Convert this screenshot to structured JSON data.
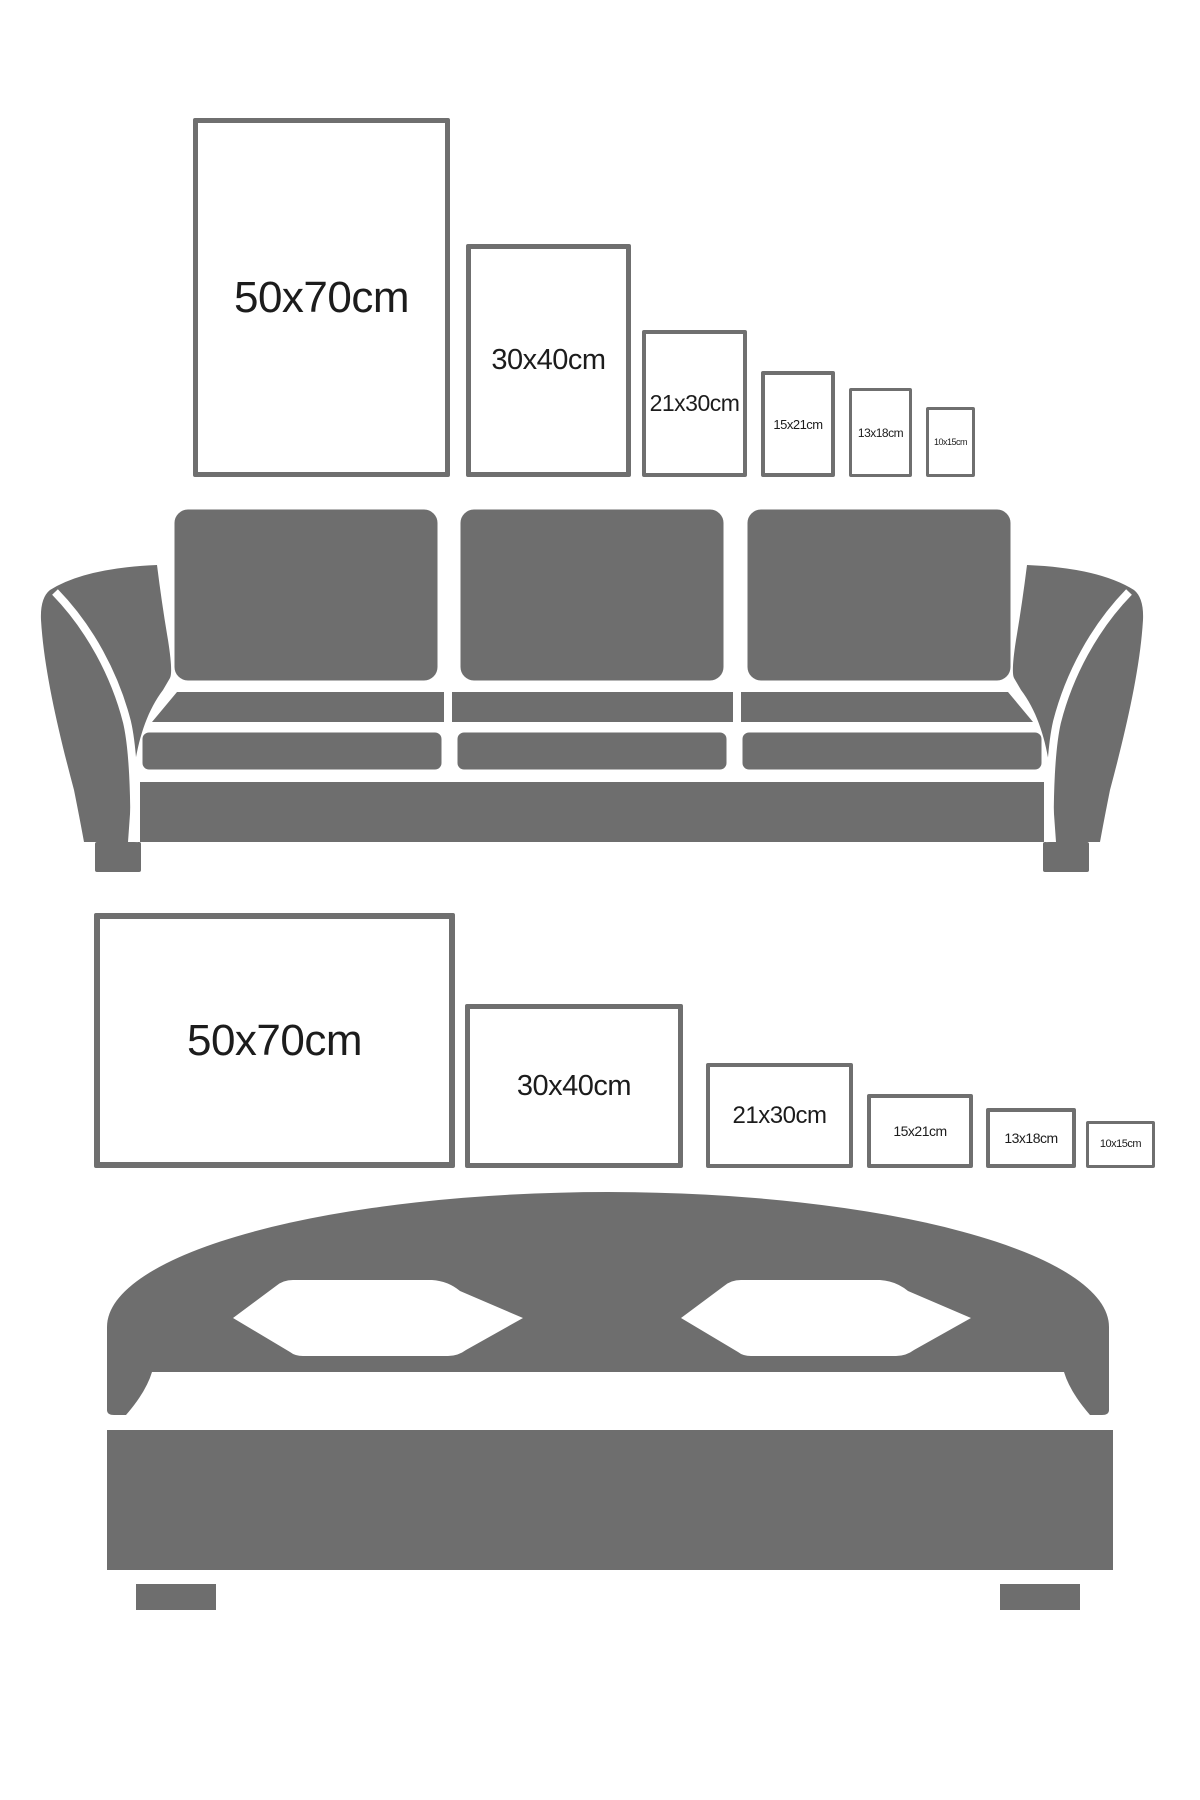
{
  "page": {
    "background_color": "#ffffff",
    "furniture_color": "#6e6e6e",
    "frame_border_color": "#6f6f6f",
    "label_color": "#1c1c1c"
  },
  "sections": [
    {
      "name": "portrait print sizes above sofa",
      "orientation": "portrait",
      "furniture": "sofa",
      "frames": [
        {
          "label": "50x70cm",
          "width_cm": 50,
          "height_cm": 70
        },
        {
          "label": "30x40cm",
          "width_cm": 30,
          "height_cm": 40
        },
        {
          "label": "21x30cm",
          "width_cm": 21,
          "height_cm": 30
        },
        {
          "label": "15x21cm",
          "width_cm": 15,
          "height_cm": 21
        },
        {
          "label": "13x18cm",
          "width_cm": 13,
          "height_cm": 18
        },
        {
          "label": "10x15cm",
          "width_cm": 10,
          "height_cm": 15
        }
      ]
    },
    {
      "name": "landscape print sizes above bed",
      "orientation": "landscape",
      "furniture": "bed",
      "frames": [
        {
          "label": "50x70cm",
          "width_cm": 70,
          "height_cm": 50
        },
        {
          "label": "30x40cm",
          "width_cm": 40,
          "height_cm": 30
        },
        {
          "label": "21x30cm",
          "width_cm": 30,
          "height_cm": 21
        },
        {
          "label": "15x21cm",
          "width_cm": 21,
          "height_cm": 15
        },
        {
          "label": "13x18cm",
          "width_cm": 18,
          "height_cm": 13
        },
        {
          "label": "10x15cm",
          "width_cm": 15,
          "height_cm": 10
        }
      ]
    }
  ]
}
